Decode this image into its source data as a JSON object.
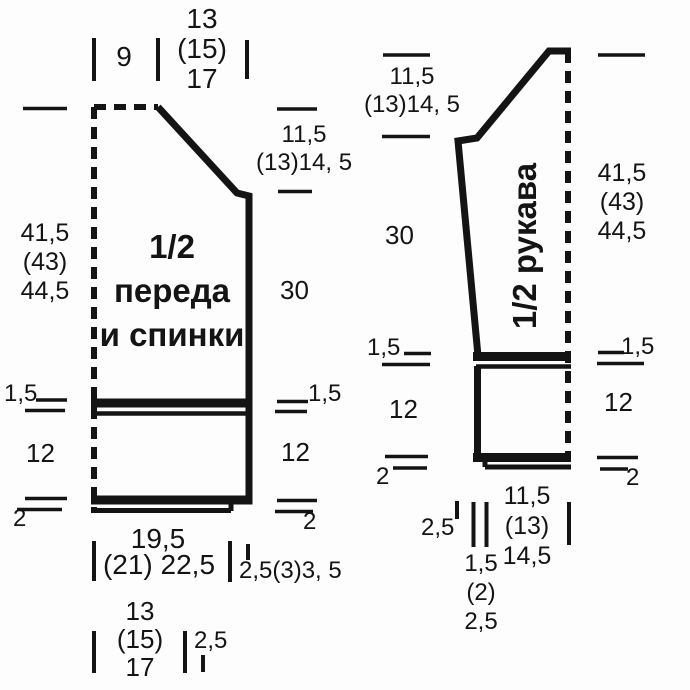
{
  "colors": {
    "ink": "#141414",
    "bg": "#fdfdfd"
  },
  "front_back": {
    "title": [
      "1/2",
      "переда",
      "и спинки"
    ],
    "shoulder_width": "9",
    "neck_width": [
      "13",
      "(15)",
      "17"
    ],
    "neck_depth": [
      "11,5",
      "(13)14, 5"
    ],
    "side_height": [
      "41,5",
      "(43)",
      "44,5"
    ],
    "body_height": "30",
    "band_height": "1,5",
    "rib_height": "12",
    "hem_height": "2",
    "hip_width_top": "19,5",
    "hip_width_bottom": "(21) 22,5",
    "side_slant": "2,5(3)3, 5",
    "cast_on_width": [
      "13",
      "(15)",
      "17"
    ],
    "cast_on_slant": "2,5"
  },
  "sleeve": {
    "title": "1/2 рукава",
    "cap_depth": [
      "11,5",
      "(13)14, 5"
    ],
    "side_height": [
      "41,5",
      "(43)",
      "44,5"
    ],
    "upper_height": "30",
    "band_height": "1,5",
    "rib_height": "12",
    "hem_height": "2",
    "wrist_width": [
      "11,5",
      "(13)",
      "14,5"
    ],
    "seam_width": "2,5",
    "slant_width": [
      "1,5",
      "(2)",
      "2,5"
    ]
  }
}
